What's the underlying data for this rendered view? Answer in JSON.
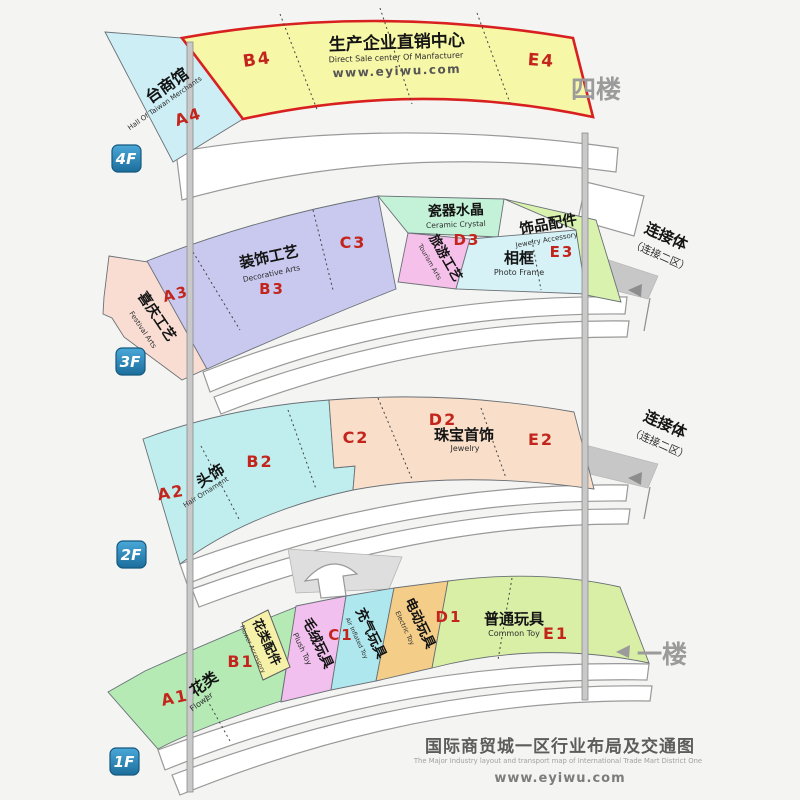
{
  "floor4": {
    "badge": "4F",
    "side_label": "四楼",
    "taiwan_hall": {
      "cn": "台商馆",
      "en": "Hall Of Taiwan Merchants",
      "code": "A4"
    },
    "b4_code": "B4",
    "direct_sale_center": {
      "cn": "生产企业直销中心",
      "en": "Direct Sale center Of Manfacturer",
      "website": "www.eyiwu.com"
    },
    "e4_code": "E4"
  },
  "floor3": {
    "badge": "3F",
    "connector": {
      "line1": "连接体",
      "line2": "（连接二区）"
    },
    "festival_arts": {
      "cn": "喜庆工艺",
      "en": "Festival Arts",
      "code": "A3"
    },
    "decorative_arts": {
      "cn": "装饰工艺",
      "en": "Decorative Arts",
      "code": "B3"
    },
    "c3_code": "C3",
    "ceramic_crystal": {
      "cn": "瓷器水晶",
      "en": "Ceramic Crystal",
      "code": "D3"
    },
    "tourism_arts": {
      "cn": "旅游工艺",
      "en": "Tourism Arts"
    },
    "photo_frame": {
      "cn": "相框",
      "en": "Photo Frame"
    },
    "jewelry_accessory": {
      "cn": "饰品配件",
      "en": "Jewelry Accessory",
      "code": "E3"
    }
  },
  "floor2": {
    "badge": "2F",
    "connector": {
      "line1": "连接体",
      "line2": "（连接二区）"
    },
    "a2_code": "A2",
    "hair_ornament": {
      "cn": "头饰",
      "en": "Hair Ornament",
      "code": "B2"
    },
    "c2_code": "C2",
    "jewelry": {
      "cn": "珠宝首饰",
      "en": "Jewelry",
      "code": "D2"
    },
    "e2_code": "E2"
  },
  "floor1": {
    "badge": "1F",
    "side_label": "一楼",
    "flower": {
      "cn": "花类",
      "en": "Flower",
      "code": "A1"
    },
    "flower_accessory": {
      "cn": "花类配件",
      "en": "Flower Accessory",
      "code": "B1"
    },
    "plush_toy": {
      "cn": "毛绒玩具",
      "en": "Plush Toy",
      "code": "C1"
    },
    "inflated_toy": {
      "cn": "充气玩具",
      "en": "Air Inflated Toy"
    },
    "electric_toy": {
      "cn": "电动玩具",
      "en": "Electric Toy",
      "code": "D1"
    },
    "common_toy": {
      "cn": "普通玩具",
      "en": "Common Toy",
      "code": "E1"
    }
  },
  "footer": {
    "title_cn": "国际商贸城一区行业布局及交通图",
    "title_en": "The Major Industry layout and transport map of International Trade Mart District One",
    "website": "www.eyiwu.com"
  },
  "colors": {
    "highlight_border": "#d92020",
    "code_red": "#c3251d",
    "badge_blue": "#2583b5",
    "taiwan_hall_fill": "#cdeef5",
    "direct_sale_fill": "#f7f7a8",
    "festival_fill": "#f9ddd3",
    "decorative_fill": "#c9c9ef",
    "ceramic_fill": "#c4f2d9",
    "tourism_fill": "#f5c0ea",
    "photo_frame_fill": "#d6f2f6",
    "jewelry_accessory_fill": "#d9f3ae",
    "hair_fill": "#c0eeee",
    "jewelry_fill": "#f9dfca",
    "flower_fill": "#b5eab5",
    "flower_accessory_fill": "#f5f1a8",
    "plush_fill": "#f2c0ee",
    "inflated_fill": "#aee8ee",
    "electric_fill": "#f4cd88",
    "common_toy_fill": "#d9efa5"
  }
}
